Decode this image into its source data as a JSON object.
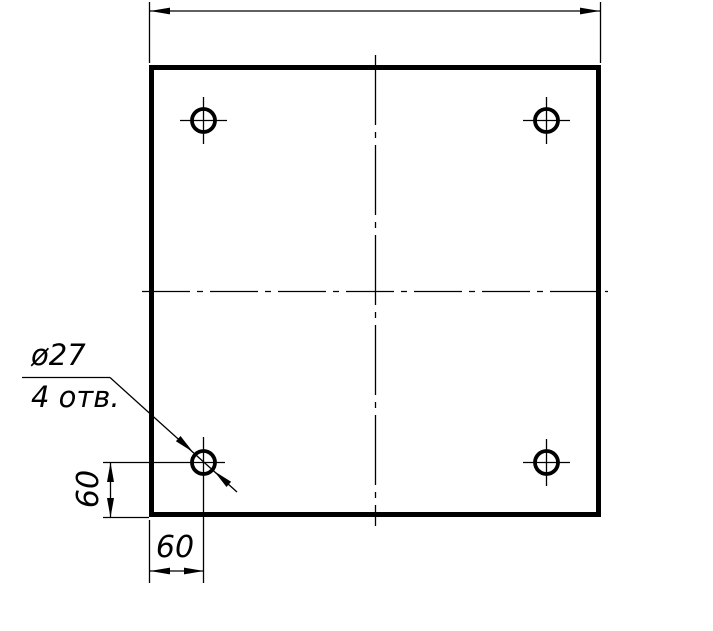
{
  "page": {
    "background_color": "#ffffff",
    "line_color": "#000000"
  },
  "drawing": {
    "type": "engineering-drawing-plate-with-holes",
    "leader_note": {
      "diameter_label": "ø27",
      "holes_label": "4 отв."
    },
    "dimensions": {
      "hole_offset_vertical": "60",
      "hole_offset_horizontal": "60"
    }
  }
}
